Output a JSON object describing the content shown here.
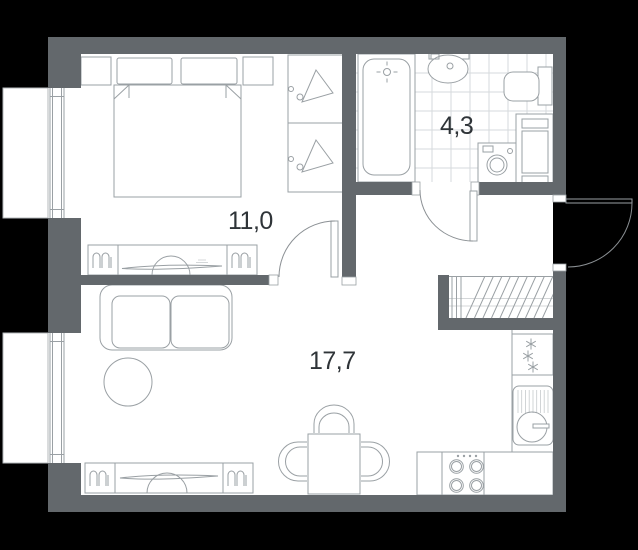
{
  "meta": {
    "kind": "apartment-floor-plan"
  },
  "colors": {
    "background": "#000000",
    "wall": "#63686c",
    "floor": "#ffffff",
    "line": "#9aa0a4",
    "line-light": "#c6cacd",
    "tile": "#d6dadc",
    "arc": "#8b9094",
    "text": "#2f3438"
  },
  "rooms": {
    "bedroom": {
      "name": "bedroom",
      "area_label": "11,0"
    },
    "bathroom": {
      "name": "bathroom",
      "area_label": "4,3"
    },
    "living_kitchen": {
      "name": "living-kitchen",
      "area_label": "17,7"
    }
  }
}
